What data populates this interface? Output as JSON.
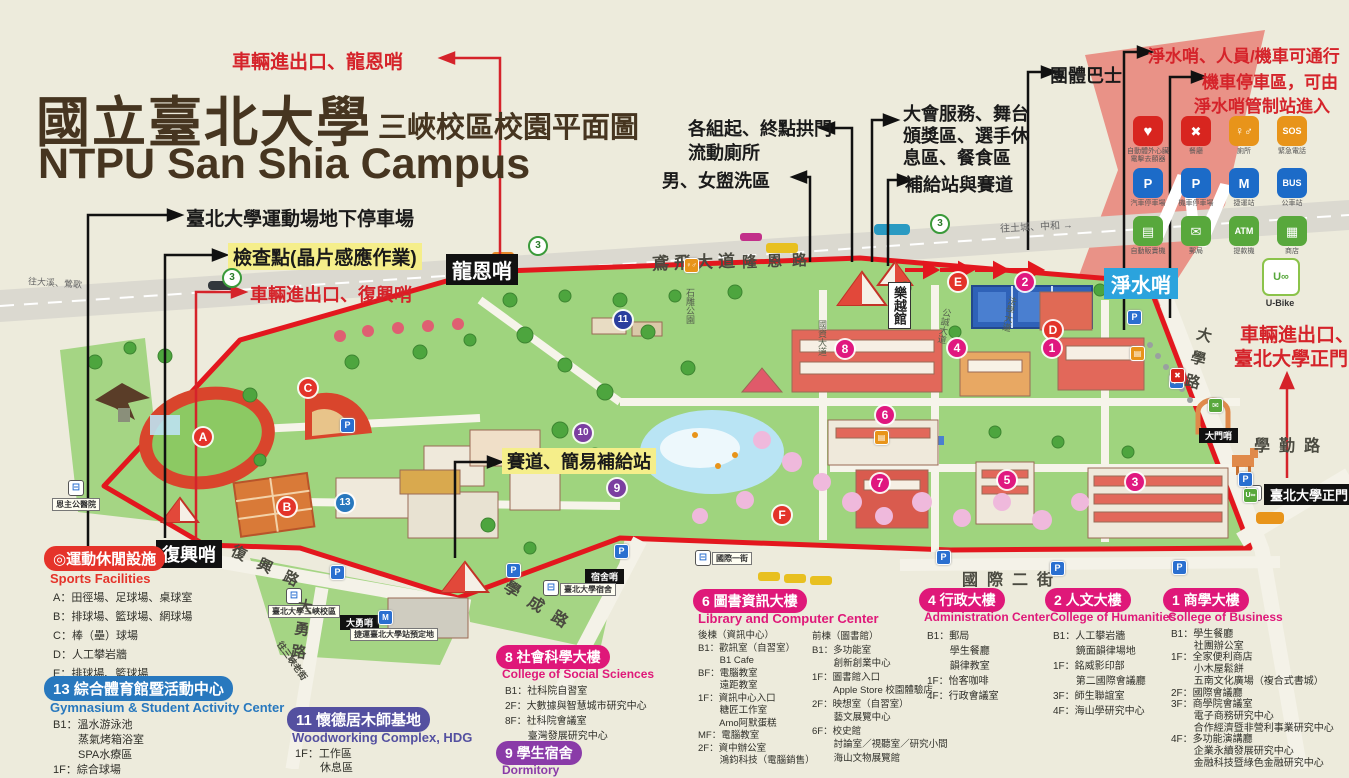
{
  "title": {
    "zh": "國立臺北大學",
    "zh2": "三峽校區校園平面圖",
    "en": "NTPU San Shia Campus"
  },
  "compass": {
    "n": "N"
  },
  "annotations": {
    "gate_longen": "車輛進出口、龍恩哨",
    "sports_parking": "臺北大學運動場地下停車場",
    "checkpoint": "檢查點(晶片感應作業)",
    "gate_fuxing": "車輛進出口、復興哨",
    "arch": "各組起、終點拱門",
    "arch2": "流動廁所",
    "washroom": "男、女盥洗區",
    "service1": "大會服務、舞台",
    "service2": "頒獎區、選手休",
    "service3": "息區、餐食區",
    "supply": "補給站與賽道",
    "bus_group": "團體巴士",
    "jingshui_pass": "淨水哨、人員/機車可通行",
    "moto1": "機車停車區，可由",
    "moto2": "淨水哨管制站進入",
    "main_gate1": "車輛進出口、",
    "main_gate2": "臺北大學正門",
    "racetrack": "賽道、簡易補給站"
  },
  "posts": {
    "longen": "龍恩哨",
    "fuxing": "復興哨",
    "jingshui": "淨水哨",
    "damen": "大門哨",
    "dorm_post": "宿舍哨",
    "dayong": "大勇哨"
  },
  "stops": {
    "enzhugong": "恩主公醫院",
    "campus": "臺北大學三峽校區",
    "dorm": "臺北大學宿舍",
    "main_gate": "臺北大學正門",
    "intl": "國際一街",
    "mrt": "捷運臺北大學站預定地"
  },
  "roads": {
    "yanfei": "鳶飛大道",
    "longen": "隆恩路",
    "fuxing": "復興路",
    "dayong": "大勇路",
    "xuecheng": "學成路",
    "daxue": "大學路",
    "xueqin": "學勤路",
    "intl2": "國際二街",
    "old_street": "往三峽老街",
    "stone": "石雕公園",
    "guozi": "國資大道",
    "gongcheng": "公誠大道",
    "faxue": "法學大道",
    "leyue": "樂越館"
  },
  "highway": {
    "left": "往大溪、鶯歌",
    "right": "往土城、中和 →",
    "route3": "3"
  },
  "legend": {
    "items": [
      {
        "g": "♥",
        "label": "自動體外心臟 電擊去顫器"
      },
      {
        "g": "✖",
        "label": "餐廳"
      },
      {
        "g": "♀♂",
        "label": "廁所"
      },
      {
        "g": "SOS",
        "label": "緊急電話"
      },
      {
        "g": "P",
        "label": "汽車停車場"
      },
      {
        "g": "P",
        "label": "機車停車場"
      },
      {
        "g": "M",
        "label": "捷運站"
      },
      {
        "g": "BUS",
        "label": "公車站"
      },
      {
        "g": "▤",
        "label": "自動販賣機"
      },
      {
        "g": "✉",
        "label": "郵局"
      },
      {
        "g": "ATM",
        "label": "提款機"
      },
      {
        "g": "▦",
        "label": "商店"
      }
    ],
    "ubike": {
      "g": "U∞",
      "label": "U-Bike"
    }
  },
  "markers": {
    "mA": "A",
    "mB": "B",
    "mC": "C",
    "mD": "D",
    "mE": "E",
    "mF": "F",
    "m1": "1",
    "m2": "2",
    "m3": "3",
    "m4": "4",
    "m5": "5",
    "m6": "6",
    "m7": "7",
    "m8": "8",
    "m9": "9",
    "m10": "10",
    "m11": "11",
    "m13": "13"
  },
  "sections": {
    "sports": {
      "title": "◎運動休閒設施",
      "subtitle": "Sports Facilities",
      "items": [
        "A：田徑場、足球場、桌球室",
        "B：排球場、籃球場、網球場",
        "C：棒（壘）球場",
        "D：人工攀岩牆",
        "E：排球場、籃球場",
        "F：心湖會館預定地"
      ]
    },
    "gym13": {
      "title": "13 綜合體育館暨活動中心",
      "subtitle": "Gymnasium & Student Activity Center",
      "items": [
        "B1：溫水游泳池",
        "　　 蒸氣烤箱浴室",
        "　　 SPA水療區",
        "1F：綜合球場"
      ]
    },
    "hdg11": {
      "title": "11 懷德居木師基地",
      "subtitle": "Woodworking Complex, HDG",
      "items": [
        "1F：工作區",
        "　　 休息區"
      ]
    },
    "social8": {
      "title": "8 社會科學大樓",
      "subtitle": "College of Social Sciences",
      "items": [
        "B1：社科院自習室",
        "2F：大數據與智慧城市研究中心",
        "8F：社科院會議室",
        "　　 臺灣發展研究中心"
      ]
    },
    "dorm9": {
      "title": "9 學生宿舍",
      "subtitle": "Dormitory"
    },
    "library6": {
      "title": "6 圖書資訊大樓",
      "subtitle": "Library and Computer Center",
      "left": [
        "後棟（資訊中心）",
        "B1：歡訊室（自習室）",
        "　　 B1 Cafe",
        "BF：電腦教室",
        "　　 遠距教室",
        "1F：資訊中心入口",
        "　　 糖匠工作室",
        "　　 Amo阿默蛋糕",
        "MF：電腦教室",
        "2F：資中辦公室",
        "　　 鴻鈞科技（電腦銷售）"
      ],
      "right": [
        "前棟（圖書館）",
        "B1：多功能室",
        "　　 創新創業中心",
        "1F：圖書館入口",
        "　　 Apple Store 校園體驗店",
        "2F：映想室（自習室）",
        "　　 藝文展覽中心",
        "6F：校史館",
        "　　 討論室／視聽室／研究小間",
        "　　 海山文物展覽館"
      ]
    },
    "admin4": {
      "title": "4 行政大樓",
      "subtitle": "Administration Center",
      "items": [
        "B1：郵局",
        "　　 學生餐廳",
        "　　 韻律教室",
        "1F：怡客咖啡",
        "4F：行政會議室"
      ]
    },
    "hum2": {
      "title": "2 人文大樓",
      "subtitle": "College of Humanities",
      "items": [
        "B1：人工攀岩牆",
        "　　 鏡面韻律場地",
        "1F：銘威影印部",
        "　　 第二國際會議廳",
        "3F：師生聯誼室",
        "4F：海山學研究中心"
      ]
    },
    "biz1": {
      "title": "1 商學大樓",
      "subtitle": "College of Business",
      "items": [
        "B1：學生餐廳",
        "　　 社團辦公室",
        "1F：全家便利商店",
        "　　 小木屋鬆餅",
        "　　 五南文化廣場（複合式書城）",
        "2F：國際會議廳",
        "3F：商學院會議室",
        "　　 電子商務研究中心",
        "　　 合作經濟暨非營利事業研究中心",
        "4F：多功能演講廳",
        "　　 企業永續發展研究中心",
        "　　 金融科技暨綠色金融研究中心"
      ]
    }
  },
  "colors": {
    "route_red": "#e3171e",
    "pill_pink": "#e0187f",
    "accent_blue": "#2878be"
  }
}
